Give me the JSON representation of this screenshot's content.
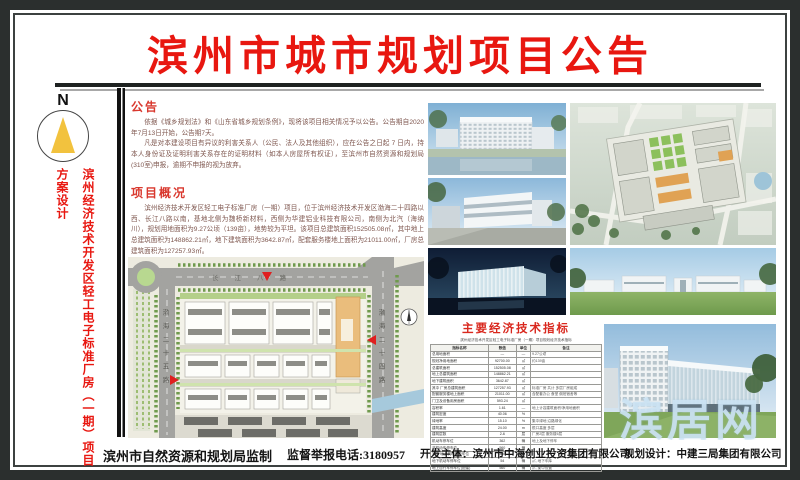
{
  "palette": {
    "frame": "#2b2f2e",
    "title_red": "#e81710",
    "heading_red": "#d9382e",
    "body_text": "#7f574f",
    "watermark_blue": "#cde4f4"
  },
  "title": "滨州市城市规划项目公告",
  "sidebar": {
    "compass_label": "N",
    "project_title": "滨州经济技术开发区轻工电子标准厂房（一期）项目方案设计"
  },
  "announcement": {
    "heading": "公告",
    "para1": "依据《城乡规划法》和《山东省城乡规划条例》，现将该项目相关情况予以公告。公告期自2020年7月13日开始，公告期7天。",
    "para2": "凡是对本建设项目有异议的利害关系人（公民、法人及其他组织），应在公告之日起 7 日内，持本人身份证及证明利害关系存在的证明材料（如本人房屋所有权证），至滨州市自然资源和规划局(310室)申报，逾期不申报的视为放弃。"
  },
  "overview": {
    "heading": "项目概况",
    "para": "滨州经济技术开发区轻工电子标准厂房（一期）项目，位于滨州经济技术开发区渤海二十四路以西、长江八路以南，基地北侧为魏桥新材料，西侧为华建铝业科技有限公司，南侧为北汽（海纳川），规划用地面积为9.27公顷（139亩），地势较为平坦。该项目总建筑面积152505.08㎡，其中地上总建筑面积为148862.21㎡，地下建筑面积为3642.87㎡，配套服务楼地上面积为21011.00㎡，厂房总建筑面积为127257.93㎡。"
  },
  "site_plan": {
    "road_top": "长江八路",
    "road_left": "渤海二十五路",
    "road_right": "渤海二十四路"
  },
  "indicators": {
    "title": "主要经济技术指标",
    "caption": "滨州经济技术开发区轻工电子标准厂房（一期）项目规划经济技术指标",
    "columns": [
      "指标名称",
      "数值",
      "单位",
      "备注"
    ],
    "rows": [
      [
        "总用地面积",
        "—",
        "—",
        "9.27公顷"
      ],
      [
        "规划净用地面积",
        "92700.00",
        "㎡",
        "约139亩"
      ],
      [
        "总建筑面积",
        "152505.08",
        "㎡",
        ""
      ],
      [
        "地上总建筑面积",
        "148862.21",
        "㎡",
        ""
      ],
      [
        "地下建筑面积",
        "3642.87",
        "㎡",
        ""
      ],
      [
        "其中 厂房总建筑面积",
        "127257.93",
        "㎡",
        "标准厂房 共计 多层厂房组成"
      ],
      [
        "配套服务楼地上面积",
        "21011.00",
        "㎡",
        "含配套办公 食堂 倒班宿舍等"
      ],
      [
        "门卫及设备用房面积",
        "593.24",
        "㎡",
        ""
      ],
      [
        "容积率",
        "1.61",
        "—",
        "地上计容建筑面积/净用地面积"
      ],
      [
        "建筑密度",
        "40.06",
        "%",
        ""
      ],
      [
        "绿地率",
        "15.10",
        "%",
        "集中绿地 沿路绿化"
      ],
      [
        "建筑高度",
        "24.00",
        "m",
        "檐口高度 多层"
      ],
      [
        "建筑层数",
        "2-6",
        "层",
        "厂房2层 服务楼6层"
      ],
      [
        "机动车停车位",
        "362",
        "辆",
        "地上及地下停车"
      ],
      [
        "非机动车停车位",
        "560",
        "辆",
        ""
      ],
      [
        "其中 地上机动车停车位",
        "308",
        "辆",
        ""
      ],
      [
        "地下机动车停车位",
        "54",
        "辆",
        "㎡, 地下车库"
      ],
      [
        "地上自行车停车位(配建)",
        "560",
        "辆",
        "㎡, 集中设置"
      ]
    ]
  },
  "watermark": "滨居网",
  "footer": {
    "producer": "滨州市自然资源和规划局监制",
    "hotline": "监督举报电话:3180957",
    "developer": "开发主体：滨州市中海创业投资集团有限公司",
    "designer": "规划设计：中建三局集团有限公司"
  }
}
